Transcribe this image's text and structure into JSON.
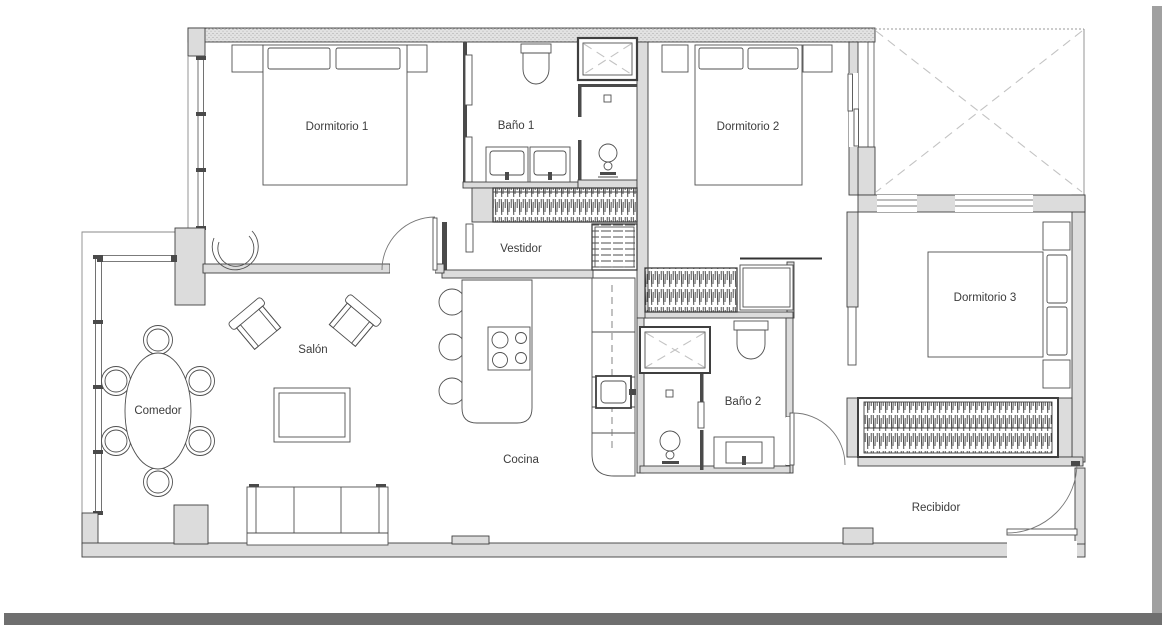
{
  "floorplan": {
    "title": "Apartment floor plan",
    "rooms": [
      {
        "id": "dormitorio-1",
        "label": "Dormitorio 1"
      },
      {
        "id": "bano-1",
        "label": "Baño 1"
      },
      {
        "id": "dormitorio-2",
        "label": "Dormitorio 2"
      },
      {
        "id": "vestidor",
        "label": "Vestidor"
      },
      {
        "id": "dormitorio-3",
        "label": "Dormitorio 3"
      },
      {
        "id": "salon",
        "label": "Salón"
      },
      {
        "id": "comedor",
        "label": "Comedor"
      },
      {
        "id": "cocina",
        "label": "Cocina"
      },
      {
        "id": "bano-2",
        "label": "Baño 2"
      },
      {
        "id": "recibidor",
        "label": "Recibidor"
      }
    ],
    "colors": {
      "background": "#ffffff",
      "wall_fill": "#dcdcdc",
      "line": "#3f3f3f",
      "furniture": "#4f4f4f",
      "terrace_dash": "#c3c3c3",
      "text": "#3c3c3c",
      "shadow_bottom": "#6f6f6f",
      "shadow_right": "#a0a0a0"
    }
  }
}
